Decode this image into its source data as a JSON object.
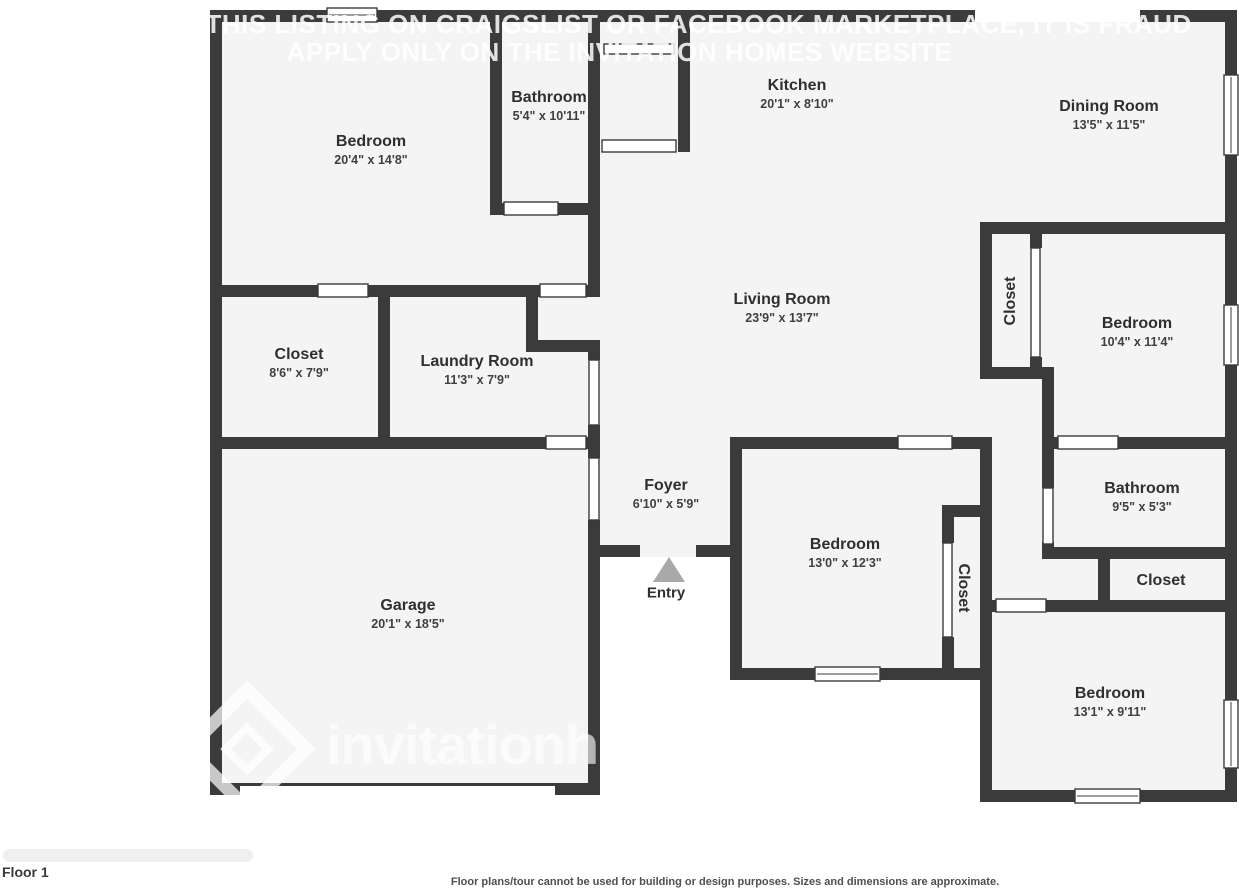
{
  "watermark": {
    "line1": "IF YOU SEE THIS LISTING ON CRAIGSLIST OR FACEBOOK MARKETPLACE, IT IS FRAUD",
    "line2": "APPLY ONLY ON THE INVITATION HOMES WEBSITE",
    "brand": "invitationhomes"
  },
  "floor_label": "Floor 1",
  "entry_label": "Entry",
  "disclaimer": "Floor plans/tour cannot be used for building or design purposes. Sizes and dimensions are approximate.",
  "colors": {
    "wall": "#3b3b3b",
    "room_fill": "#f4f4f4",
    "background": "#ffffff",
    "entry_arrow": "#a9a9a9",
    "watermark": "rgba(255,255,255,0.85)",
    "label_text": "#2f2f2f",
    "dims_text": "#3f3f3f",
    "disclaimer_text": "#4f4f4f"
  },
  "rooms": [
    {
      "id": "bedroom-top-left",
      "name": "Bedroom",
      "dims": "20'4\" x 14'8\"",
      "x": 371,
      "y": 150,
      "rotate": 0
    },
    {
      "id": "bathroom-top",
      "name": "Bathroom",
      "dims": "5'4\" x 10'11\"",
      "x": 549,
      "y": 106,
      "rotate": 0
    },
    {
      "id": "kitchen",
      "name": "Kitchen",
      "dims": "20'1\" x 8'10\"",
      "x": 797,
      "y": 94,
      "rotate": 0
    },
    {
      "id": "dining-room",
      "name": "Dining Room",
      "dims": "13'5\" x 11'5\"",
      "x": 1109,
      "y": 115,
      "rotate": 0
    },
    {
      "id": "living-room",
      "name": "Living Room",
      "dims": "23'9\" x 13'7\"",
      "x": 782,
      "y": 308,
      "rotate": 0
    },
    {
      "id": "closet-master",
      "name": "Closet",
      "dims": "8'6\" x 7'9\"",
      "x": 299,
      "y": 363,
      "rotate": 0
    },
    {
      "id": "laundry-room",
      "name": "Laundry Room",
      "dims": "11'3\" x 7'9\"",
      "x": 477,
      "y": 370,
      "rotate": 0
    },
    {
      "id": "foyer",
      "name": "Foyer",
      "dims": "6'10\" x 5'9\"",
      "x": 666,
      "y": 494,
      "rotate": 0
    },
    {
      "id": "garage",
      "name": "Garage",
      "dims": "20'1\" x 18'5\"",
      "x": 408,
      "y": 614,
      "rotate": 0
    },
    {
      "id": "bedroom-middle",
      "name": "Bedroom",
      "dims": "13'0\" x 12'3\"",
      "x": 845,
      "y": 553,
      "rotate": 0
    },
    {
      "id": "closet-bedroom-middle",
      "name": "Closet",
      "dims": "",
      "x": 963,
      "y": 588,
      "rotate": 90
    },
    {
      "id": "closet-bedroom-right",
      "name": "Closet",
      "dims": "",
      "x": 1011,
      "y": 301,
      "rotate": -90
    },
    {
      "id": "bedroom-right",
      "name": "Bedroom",
      "dims": "10'4\" x 11'4\"",
      "x": 1137,
      "y": 332,
      "rotate": 0
    },
    {
      "id": "bathroom-right",
      "name": "Bathroom",
      "dims": "9'5\" x 5'3\"",
      "x": 1142,
      "y": 497,
      "rotate": 0
    },
    {
      "id": "closet-hall",
      "name": "Closet",
      "dims": "",
      "x": 1161,
      "y": 581,
      "rotate": 0
    },
    {
      "id": "bedroom-bottom-right",
      "name": "Bedroom",
      "dims": "13'1\" x 9'11\"",
      "x": 1110,
      "y": 702,
      "rotate": 0
    }
  ]
}
